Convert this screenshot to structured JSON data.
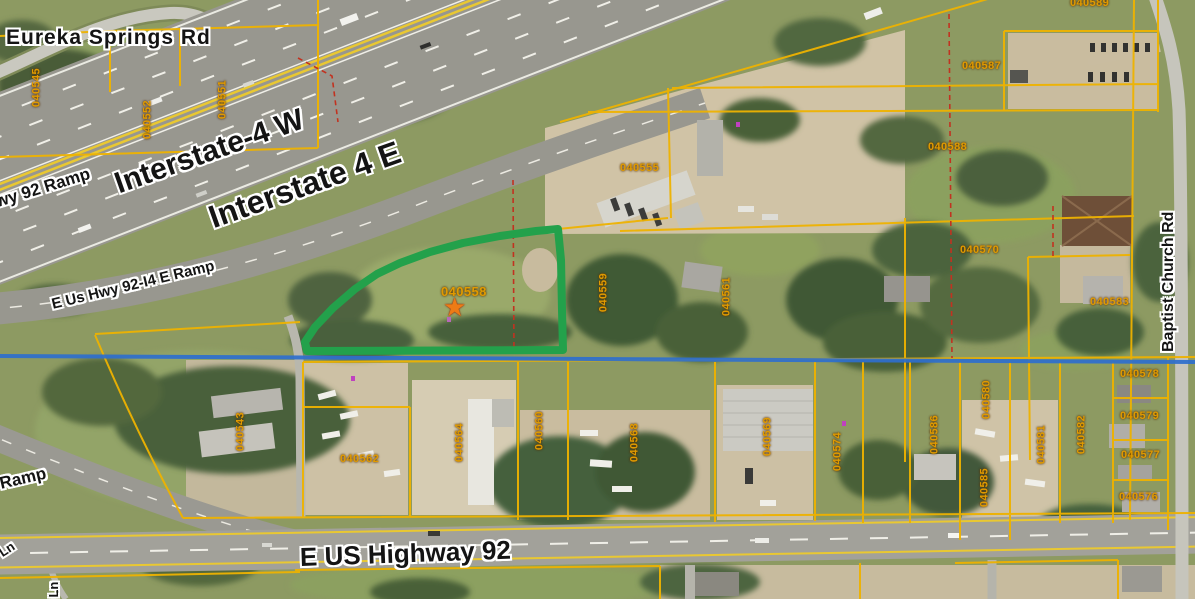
{
  "map": {
    "type": "gis-aerial-parcel-map",
    "roads": {
      "eureka_springs": "Eureka Springs Rd",
      "interstate_w": "Interstate-4 W",
      "interstate_e": "Interstate 4 E",
      "hwy92_ramp": "Hwy 92 Ramp",
      "e_us_hwy_ramp": "E Us Hwy 92-I4 E Ramp",
      "ramp": "Ramp",
      "e_us_highway_92": "E US Highway 92",
      "baptist_church": "Baptist Church Rd",
      "lane_fragment_1": "Ln",
      "lane_fragment_2": "ja Ln"
    },
    "parcels": [
      {
        "id": "040545"
      },
      {
        "id": "040552"
      },
      {
        "id": "040551"
      },
      {
        "id": "040555"
      },
      {
        "id": "040558"
      },
      {
        "id": "040559"
      },
      {
        "id": "040561"
      },
      {
        "id": "040587"
      },
      {
        "id": "040588"
      },
      {
        "id": "040589"
      },
      {
        "id": "040570"
      },
      {
        "id": "040583"
      },
      {
        "id": "040543"
      },
      {
        "id": "040562"
      },
      {
        "id": "040564"
      },
      {
        "id": "040560"
      },
      {
        "id": "040568"
      },
      {
        "id": "040569"
      },
      {
        "id": "040574"
      },
      {
        "id": "040586"
      },
      {
        "id": "040580"
      },
      {
        "id": "040585"
      },
      {
        "id": "040581"
      },
      {
        "id": "040582"
      },
      {
        "id": "040578"
      },
      {
        "id": "040579"
      },
      {
        "id": "040577"
      },
      {
        "id": "040576"
      }
    ],
    "highlight": {
      "parcel_id": "040558",
      "outline_color": "#23a14b",
      "marker": "orange-star"
    },
    "icons": {
      "star_marker": "★"
    },
    "overlay_colors": {
      "parcel_line": "#eeb200",
      "red_dashed_line": "#c23220",
      "blue_section_line": "#2e6fce",
      "parcel_label": "#e09a00",
      "highlight_green": "#23a14b"
    }
  }
}
